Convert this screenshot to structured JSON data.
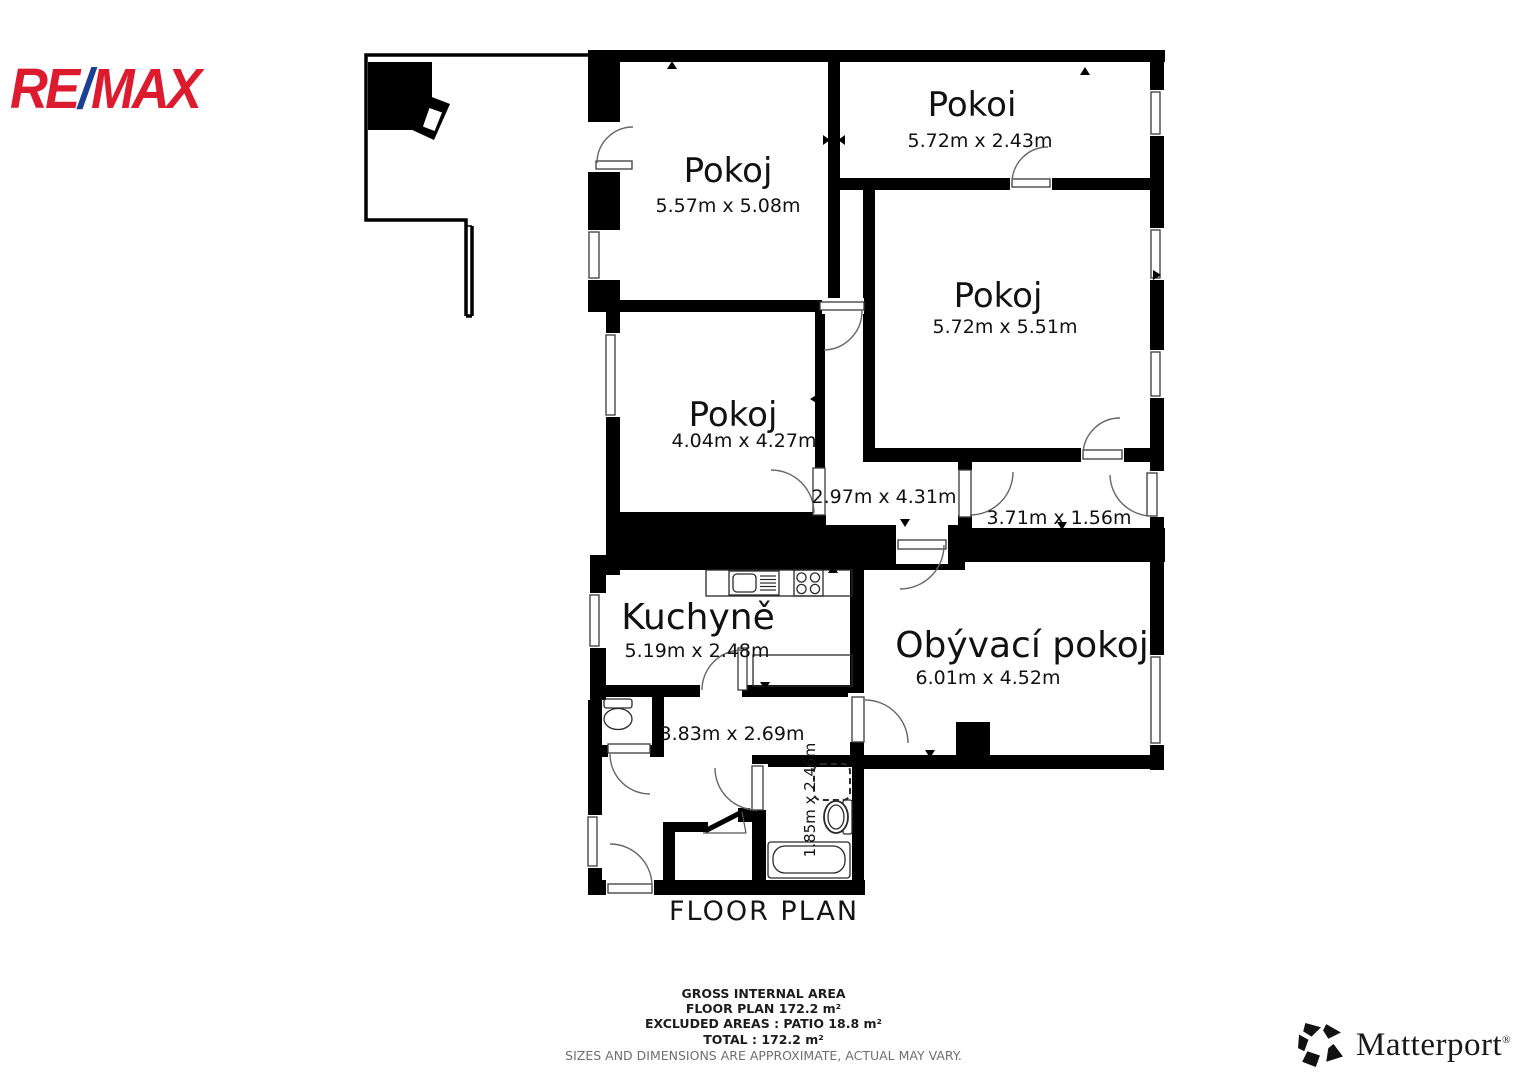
{
  "branding": {
    "remax": {
      "part1": "RE",
      "slash": "/",
      "part2": "MAX",
      "red": "#dc1c2e",
      "blue": "#1b3f94"
    },
    "matterport": {
      "name": "Matterport",
      "registered": "®"
    }
  },
  "plan": {
    "wall_color": "#000000",
    "title": "FLOOR PLAN",
    "rooms": [
      {
        "id": "pokoj-top-left",
        "name": "Pokoj",
        "dims": "5.57m x 5.08m"
      },
      {
        "id": "pokoi-top-right",
        "name": "Pokoi",
        "dims": "5.72m x 2.43m"
      },
      {
        "id": "pokoj-right",
        "name": "Pokoj",
        "dims": "5.72m x 5.51m"
      },
      {
        "id": "pokoj-middle",
        "name": "Pokoj",
        "dims": "4.04m x 4.27m"
      },
      {
        "id": "kuchyne",
        "name": "Kuchyně",
        "dims": "5.19m x 2.48m"
      },
      {
        "id": "obyvaci-pokoj",
        "name": "Obývací pokoj",
        "dims": "6.01m x 4.52m"
      }
    ],
    "areas": [
      {
        "id": "hall-upper",
        "dims": "2.97m x 4.31m"
      },
      {
        "id": "corridor",
        "dims": "3.71m x 1.56m"
      },
      {
        "id": "hall-lower",
        "dims": "3.83m x 2.69m"
      },
      {
        "id": "bathroom",
        "dims": "1.85m x 2.46m"
      }
    ]
  },
  "footer": {
    "line1": "GROSS INTERNAL AREA",
    "line2": "FLOOR PLAN 172.2 m²",
    "line3": "EXCLUDED AREAS :  PATIO 18.8 m²",
    "line4": "TOTAL :  172.2 m²",
    "disclaimer": "SIZES AND DIMENSIONS ARE APPROXIMATE, ACTUAL MAY VARY.",
    "disclaimer_color": "#6f6f6f"
  }
}
